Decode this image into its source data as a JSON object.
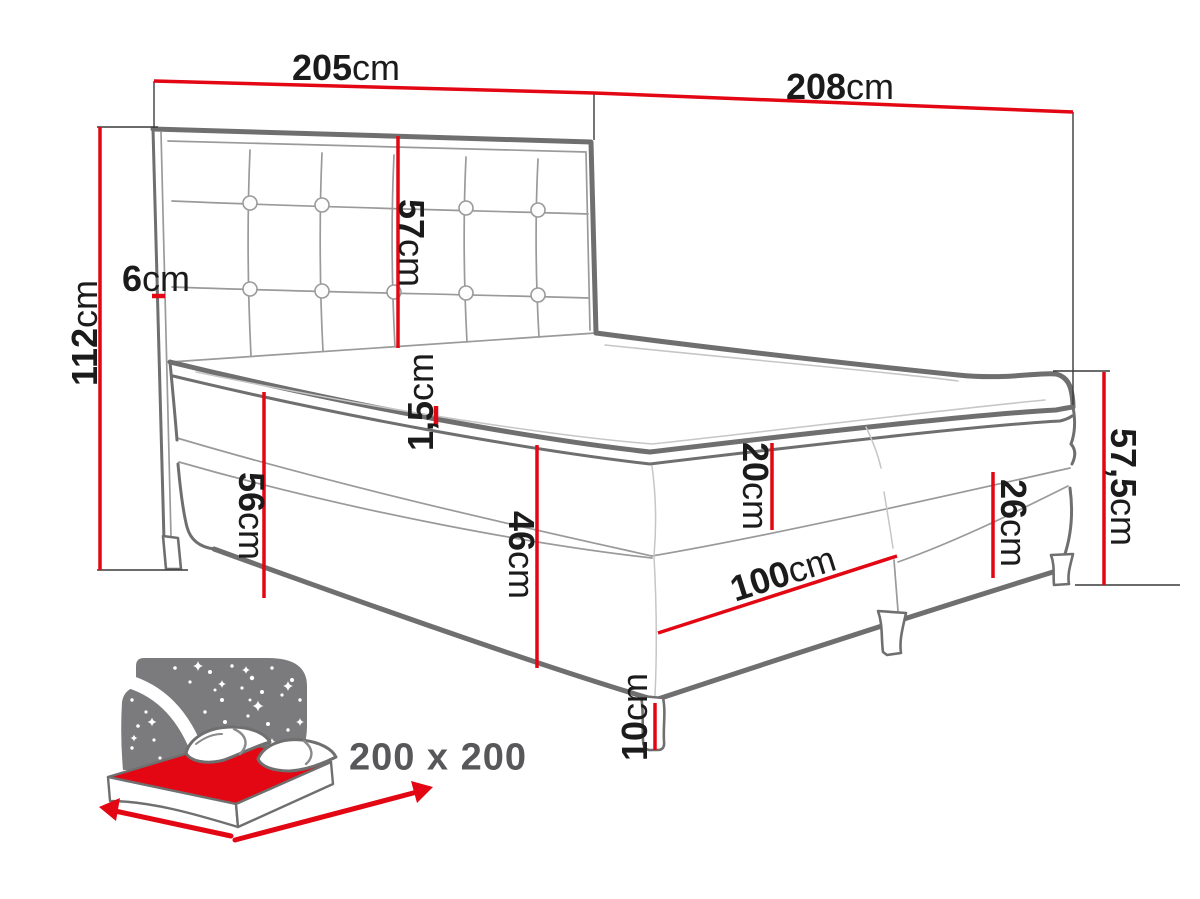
{
  "dimensions": {
    "headboard_width": {
      "value": "205",
      "unit": "cm"
    },
    "total_length": {
      "value": "208",
      "unit": "cm"
    },
    "headboard_height": {
      "value": "112",
      "unit": "cm"
    },
    "headboard_frame_thickness": {
      "value": "6",
      "unit": "cm"
    },
    "headboard_panel_height": {
      "value": "57",
      "unit": "cm"
    },
    "topper_thickness": {
      "value": "1,5",
      "unit": "cm"
    },
    "side_height": {
      "value": "56",
      "unit": "cm"
    },
    "mattress_and_base_height": {
      "value": "46",
      "unit": "cm"
    },
    "mattress_height": {
      "value": "20",
      "unit": "cm"
    },
    "base_module_width": {
      "value": "100",
      "unit": "cm"
    },
    "base_box_height": {
      "value": "26",
      "unit": "cm"
    },
    "foot_end_height": {
      "value": "57,5",
      "unit": "cm"
    },
    "leg_height": {
      "value": "10",
      "unit": "cm"
    }
  },
  "size_badge": {
    "label": "200 x 200"
  },
  "colors": {
    "dimension_red": "#e30613",
    "outline_gray": "#6f6f6f",
    "line_light_gray": "#9a9a9a",
    "line_faint_gray": "#c6c6c6",
    "extension_line_dark": "#3a3a3a",
    "icon_gray": "#7b7b7d",
    "text_black": "#1b1b1b",
    "badge_text_gray": "#58585a"
  }
}
